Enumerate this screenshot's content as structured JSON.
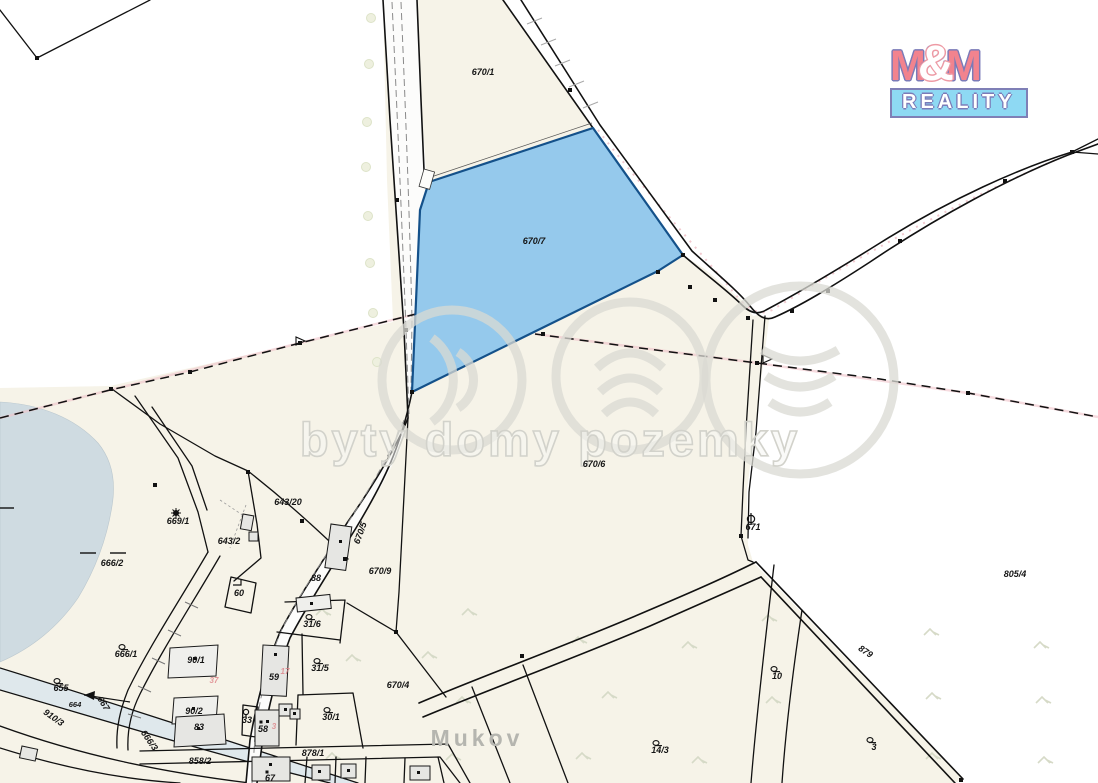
{
  "logo": {
    "m_left": "M",
    "amp": "&",
    "m_right": "M",
    "bottom": "REALITY"
  },
  "watermark": {
    "text": "byty domy pozemky"
  },
  "highlighted_parcel": {
    "id": "670/7",
    "fill": "#8cc6ec",
    "stroke": "#14518a"
  },
  "colors": {
    "parcel_cream": "#f6f3e8",
    "pond": "#cfdbe1",
    "stream": "#dfe8ec",
    "road": "#fcfcfb"
  },
  "place_name": "Mukov",
  "labels": [
    {
      "t": "670/1",
      "x": 483,
      "y": 75
    },
    {
      "t": "670/7",
      "x": 534,
      "y": 244
    },
    {
      "t": "670/6",
      "x": 594,
      "y": 467
    },
    {
      "t": "670/9",
      "x": 380,
      "y": 574
    },
    {
      "t": "670/5",
      "x": 363,
      "y": 534,
      "r": -70,
      "s": 8
    },
    {
      "t": "670/4",
      "x": 398,
      "y": 688
    },
    {
      "t": "671",
      "x": 753,
      "y": 530,
      "s": 8
    },
    {
      "t": "669/1",
      "x": 178,
      "y": 524,
      "s": 8
    },
    {
      "t": "666/2",
      "x": 112,
      "y": 566
    },
    {
      "t": "666/1",
      "x": 126,
      "y": 657
    },
    {
      "t": "666/3",
      "x": 147,
      "y": 742,
      "r": 55,
      "s": 8
    },
    {
      "t": "667",
      "x": 101,
      "y": 705,
      "r": 58,
      "s": 8
    },
    {
      "t": "655",
      "x": 61,
      "y": 691
    },
    {
      "t": "664",
      "x": 75,
      "y": 707,
      "s": 7.5
    },
    {
      "t": "910/3",
      "x": 52,
      "y": 720,
      "r": 35,
      "s": 8
    },
    {
      "t": "643/20",
      "x": 288,
      "y": 505
    },
    {
      "t": "643/2",
      "x": 229,
      "y": 544
    },
    {
      "t": "60",
      "x": 239,
      "y": 596,
      "s": 8
    },
    {
      "t": "88",
      "x": 316,
      "y": 581,
      "s": 8
    },
    {
      "t": "90/1",
      "x": 196,
      "y": 663,
      "s": 8
    },
    {
      "t": "90/2",
      "x": 194,
      "y": 714,
      "s": 8
    },
    {
      "t": "83",
      "x": 199,
      "y": 730,
      "s": 8
    },
    {
      "t": "59",
      "x": 274,
      "y": 680,
      "s": 8
    },
    {
      "t": "58",
      "x": 263,
      "y": 732,
      "s": 8
    },
    {
      "t": "33",
      "x": 247,
      "y": 723,
      "s": 8
    },
    {
      "t": "30/1",
      "x": 331,
      "y": 720
    },
    {
      "t": "31/5",
      "x": 320,
      "y": 671
    },
    {
      "t": "31/6",
      "x": 312,
      "y": 627
    },
    {
      "t": "67",
      "x": 270,
      "y": 781,
      "s": 8
    },
    {
      "t": "878/1",
      "x": 313,
      "y": 756,
      "s": 8
    },
    {
      "t": "858/2",
      "x": 200,
      "y": 764,
      "s": 8
    },
    {
      "t": "805/4",
      "x": 1015,
      "y": 577
    },
    {
      "t": "879",
      "x": 864,
      "y": 654,
      "r": 33,
      "s": 8
    },
    {
      "t": "10",
      "x": 777,
      "y": 679,
      "s": 8
    },
    {
      "t": "14/3",
      "x": 660,
      "y": 753,
      "s": 8
    },
    {
      "t": "3",
      "x": 874,
      "y": 750,
      "s": 8
    },
    {
      "t": "37",
      "x": 214,
      "y": 683,
      "c": "red"
    },
    {
      "t": "17",
      "x": 285,
      "y": 674,
      "c": "red"
    },
    {
      "t": "3",
      "x": 274,
      "y": 729,
      "c": "red"
    },
    {
      "t": "Mukov",
      "x": 477,
      "y": 746,
      "c": "place"
    }
  ],
  "symbols": [
    {
      "type": "grass",
      "x": 122,
      "y": 647
    },
    {
      "type": "grass",
      "x": 57,
      "y": 681
    },
    {
      "type": "grass",
      "x": 309,
      "y": 617
    },
    {
      "type": "grass",
      "x": 317,
      "y": 661
    },
    {
      "type": "grass",
      "x": 327,
      "y": 710
    },
    {
      "type": "grass",
      "x": 774,
      "y": 669
    },
    {
      "type": "grass",
      "x": 656,
      "y": 743
    },
    {
      "type": "grass",
      "x": 870,
      "y": 740
    },
    {
      "type": "rosette",
      "x": 176,
      "y": 513
    },
    {
      "type": "circlebar",
      "x": 751,
      "y": 519
    },
    {
      "type": "smallcircle",
      "x": 246,
      "y": 712
    },
    {
      "type": "corner",
      "x": 237,
      "y": 585
    },
    {
      "type": "dash",
      "x": 88,
      "y": 553
    },
    {
      "type": "dash",
      "x": 118,
      "y": 553
    },
    {
      "type": "dash",
      "x": 6,
      "y": 508
    },
    {
      "type": "dot",
      "x": 261,
      "y": 722
    },
    {
      "type": "dot",
      "x": 267,
      "y": 772
    }
  ],
  "survey_dots": [
    [
      683,
      255
    ],
    [
      658,
      272
    ],
    [
      412,
      392
    ],
    [
      190,
      372
    ],
    [
      300,
      343
    ],
    [
      543,
      334
    ],
    [
      757,
      363
    ],
    [
      968,
      393
    ],
    [
      748,
      318
    ],
    [
      792,
      311
    ],
    [
      690,
      287
    ],
    [
      715,
      300
    ],
    [
      828,
      291
    ],
    [
      900,
      241
    ],
    [
      1005,
      181
    ],
    [
      1072,
      152
    ],
    [
      570,
      90
    ],
    [
      406,
      330
    ],
    [
      397,
      200
    ],
    [
      248,
      472
    ],
    [
      302,
      521
    ],
    [
      345,
      559
    ],
    [
      396,
      632
    ],
    [
      522,
      656
    ],
    [
      961,
      780
    ],
    [
      741,
      536
    ],
    [
      155,
      485
    ],
    [
      111,
      389
    ],
    [
      37,
      58
    ]
  ],
  "dash_arrows": [
    [
      305,
      341
    ],
    [
      772,
      359
    ]
  ],
  "faint_marks": [
    [
      322,
      612
    ],
    [
      468,
      612
    ],
    [
      428,
      655
    ],
    [
      578,
      640
    ],
    [
      688,
      645
    ],
    [
      768,
      618
    ],
    [
      930,
      632
    ],
    [
      1040,
      645
    ],
    [
      462,
      700
    ],
    [
      608,
      695
    ],
    [
      772,
      700
    ],
    [
      932,
      696
    ],
    [
      1042,
      700
    ],
    [
      332,
      756
    ],
    [
      452,
      757
    ],
    [
      582,
      756
    ],
    [
      698,
      760
    ],
    [
      932,
      756
    ],
    [
      1044,
      760
    ],
    [
      352,
      658
    ]
  ],
  "trees": [
    [
      371,
      18
    ],
    [
      369,
      64
    ],
    [
      367,
      122
    ],
    [
      366,
      167
    ],
    [
      368,
      216
    ],
    [
      370,
      263
    ],
    [
      373,
      313
    ],
    [
      377,
      362
    ]
  ]
}
